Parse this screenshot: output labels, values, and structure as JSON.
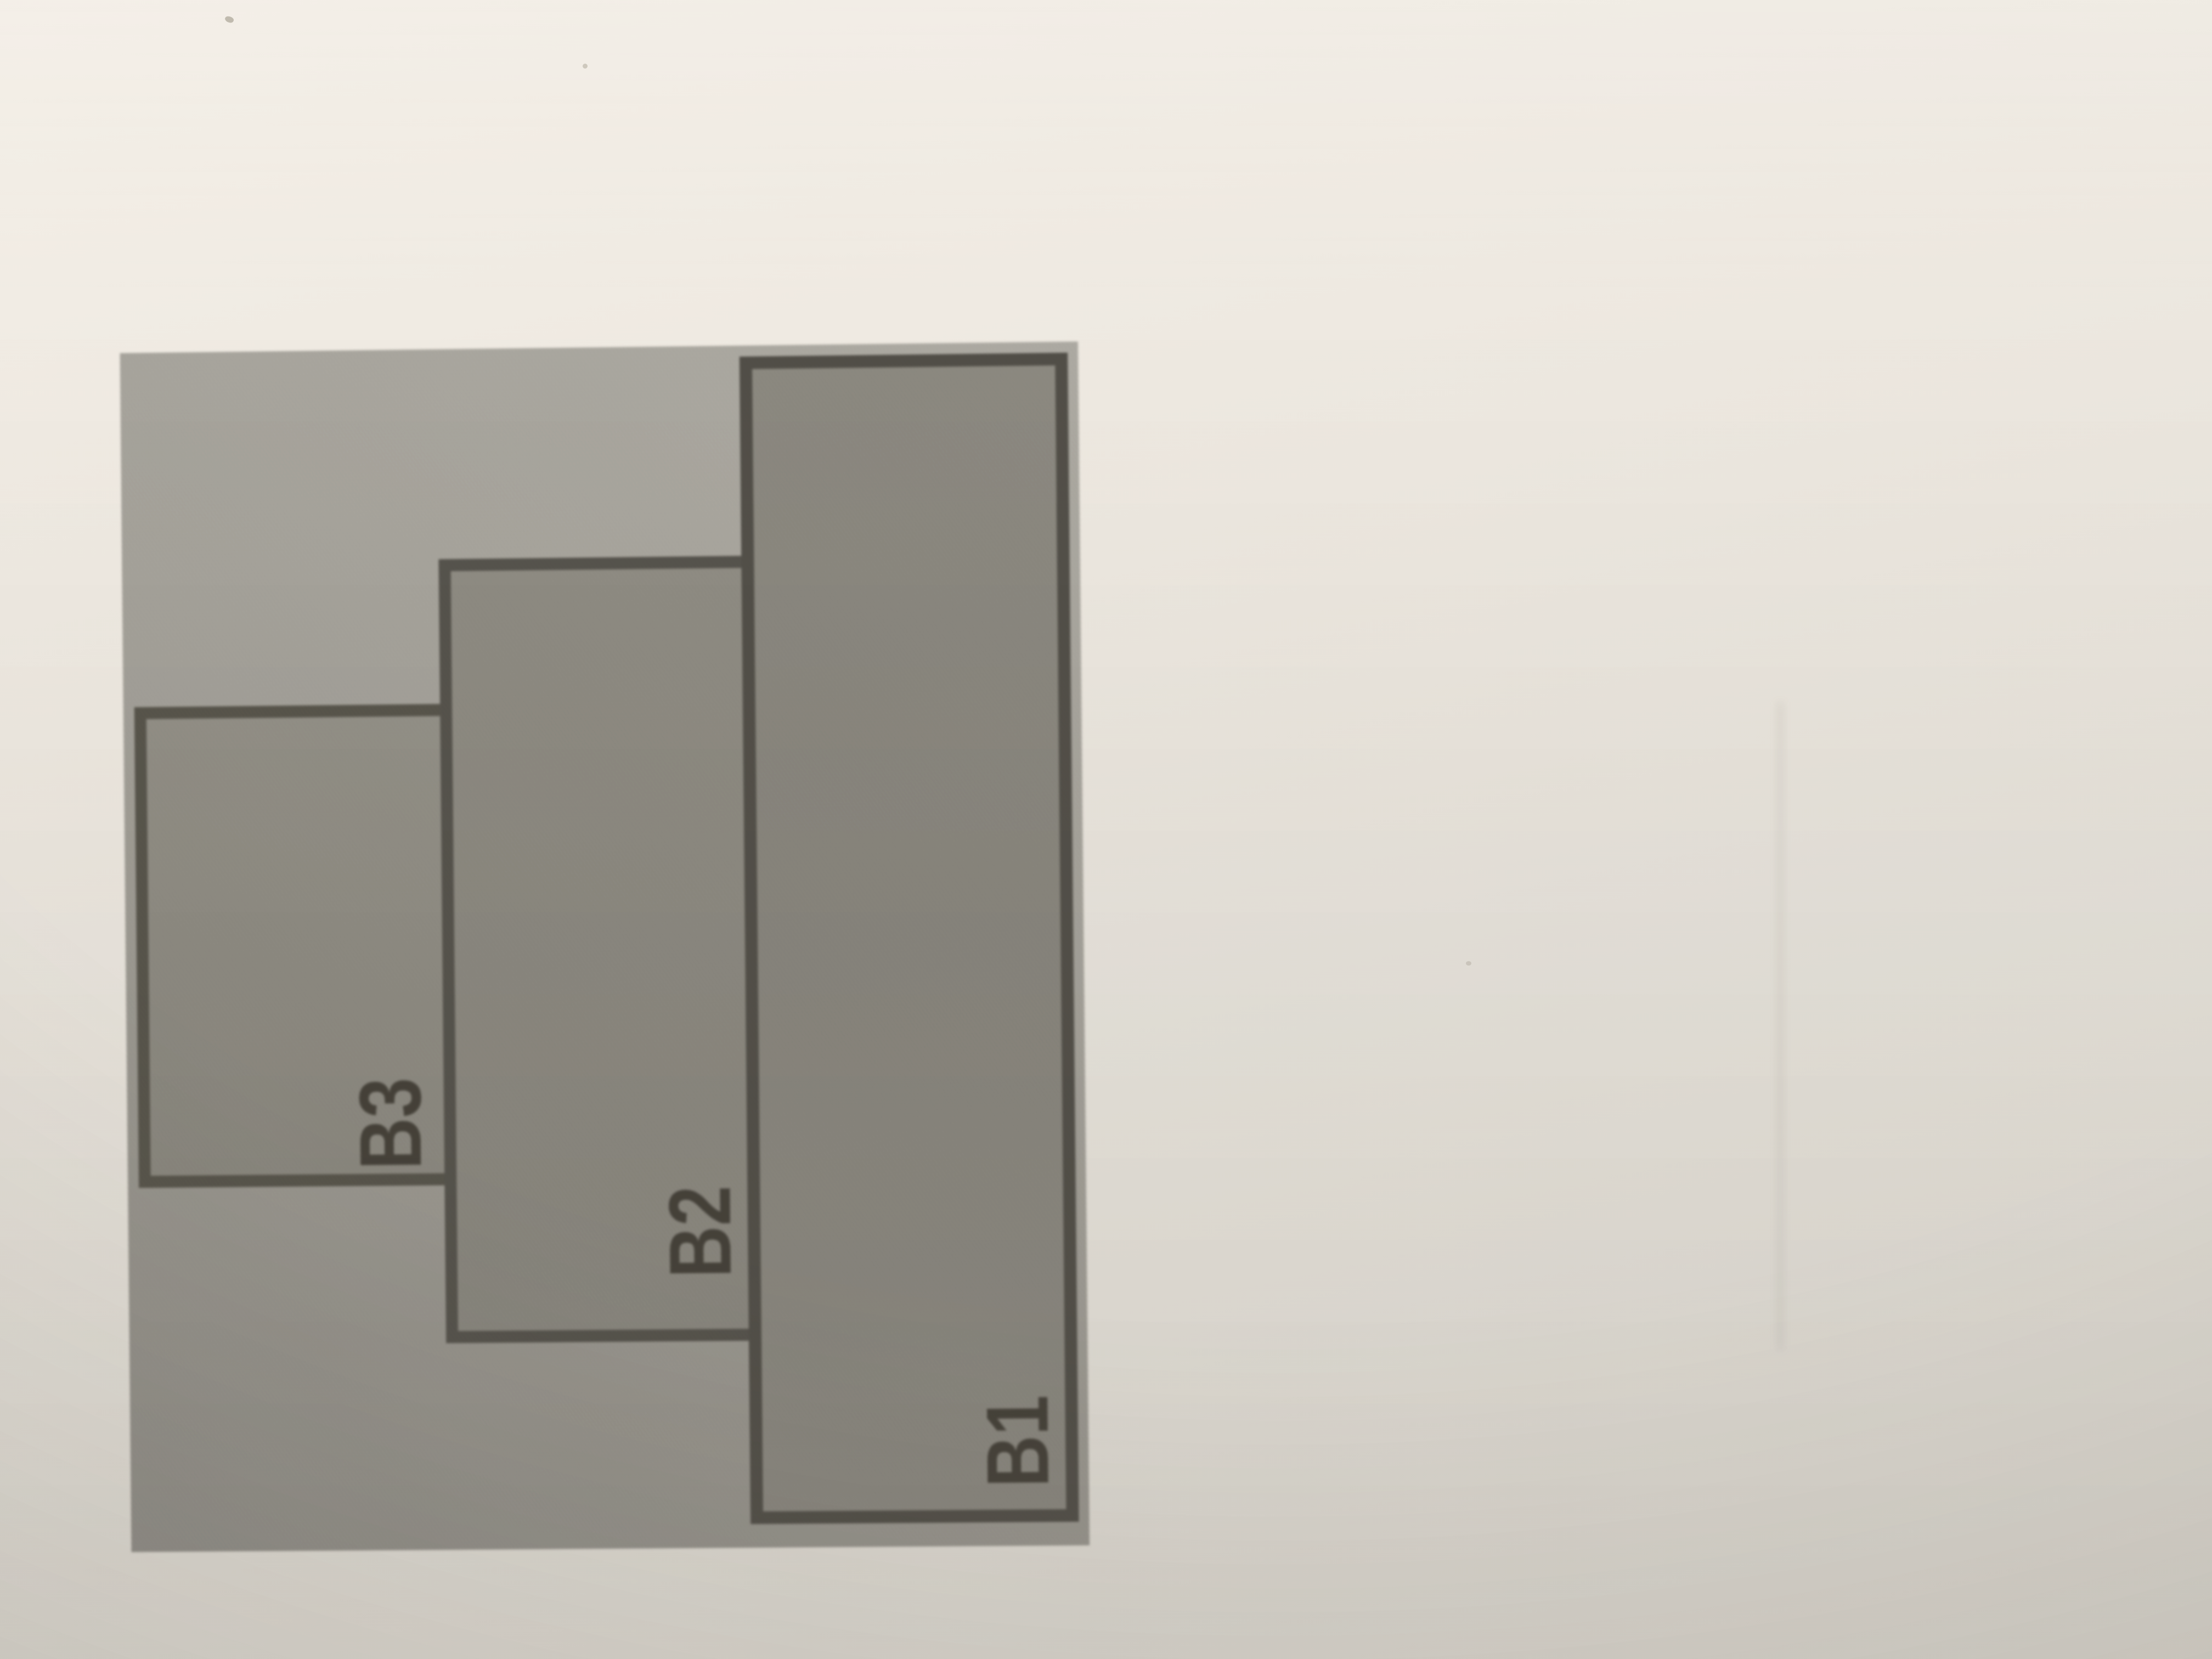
{
  "figure": {
    "kind": "stacked-blocks-diagram",
    "description": "Three overlapping rectangular blocks printed on a gray panel; labels are rotated 90 degrees counter-clockwise",
    "blocks": [
      {
        "id": "b1",
        "label": "B1"
      },
      {
        "id": "b2",
        "label": "B2"
      },
      {
        "id": "b3",
        "label": "B3"
      }
    ],
    "label_rotation_deg": -90,
    "colors": {
      "paper": "#EAE5DD",
      "panel": "#A3A098",
      "block_fill": "#8C897F",
      "block_border": "#524F48",
      "label_text": "#454139"
    }
  }
}
